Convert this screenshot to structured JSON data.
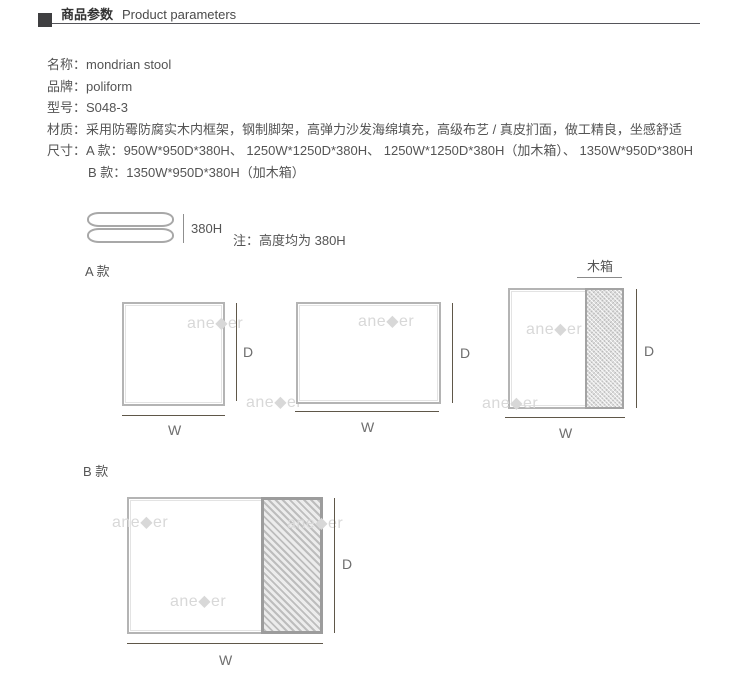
{
  "colors": {
    "header_square": "#3f3f41",
    "header_rule": "#55555a",
    "body_text": "#545454",
    "diagram_border": "#b4b4b4",
    "hatch_border": "#9e9e9e",
    "dimension_line": "#5f5749",
    "watermark_gray": "#d8d8d8"
  },
  "header": {
    "title_zh": "商品参数",
    "title_en": "Product parameters"
  },
  "specs": [
    {
      "label": "名称：",
      "value": "mondrian stool"
    },
    {
      "label": "品牌：",
      "value": "poliform"
    },
    {
      "label": "型号：",
      "value": "S048-3"
    },
    {
      "label": "材质：",
      "value": "采用防霉防腐实木内框架，钢制脚架，高弹力沙发海绵填充，高级布艺 / 真皮扪面，做工精良，坐感舒适"
    },
    {
      "label": "尺寸：",
      "value": "A 款：950W*950D*380H、 1250W*1250D*380H、 1250W*1250D*380H（加木箱）、 1350W*950D*380H"
    },
    {
      "label": "",
      "value": "B 款：1350W*950D*380H（加木箱）"
    }
  ],
  "height_figure": {
    "height_label": "380H",
    "note": "注：高度均为 380H"
  },
  "sections": {
    "a_label": "A 款",
    "b_label": "B 款"
  },
  "woodbox_label": "木箱",
  "dims": {
    "w": "W",
    "d": "D"
  },
  "watermark": "ane◆er"
}
